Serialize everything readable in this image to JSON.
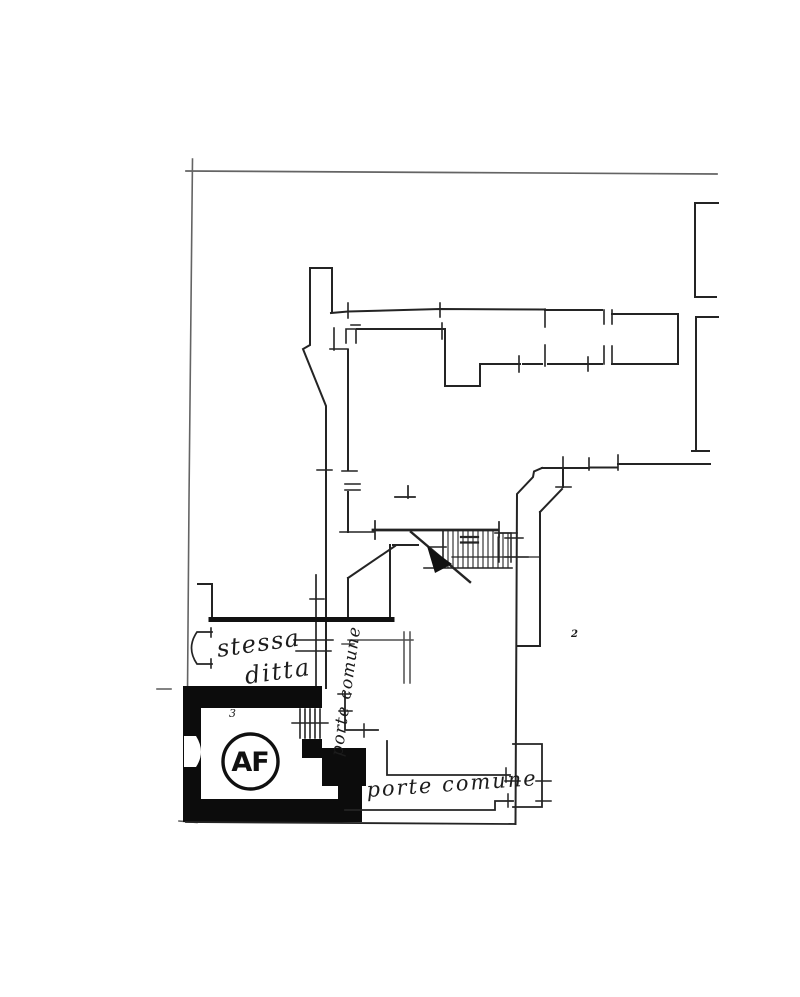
{
  "labels": {
    "same_firm_line1": "stessa",
    "same_firm_line2": "ditta",
    "common_door_vertical": "porte comune",
    "common_door_horizontal": "porte comune",
    "unit_badge": "AF",
    "stair_mark": "2",
    "room_mark": "3"
  },
  "colors": {
    "ink": "#242424",
    "wall_fill": "#0c0c0c",
    "paper": "#ffffff"
  }
}
